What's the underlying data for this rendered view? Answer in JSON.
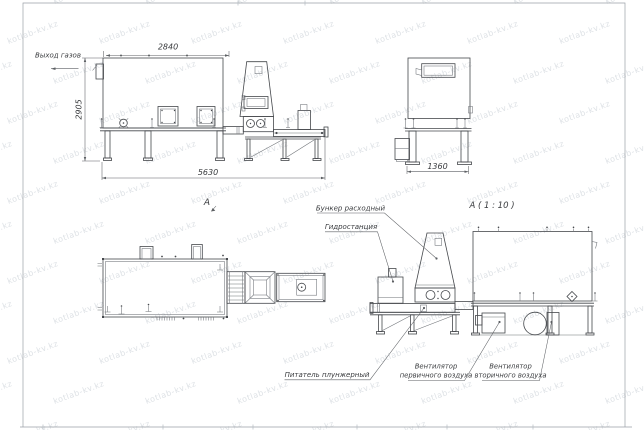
{
  "colors": {
    "line": "#45484c",
    "thin": "#6e7277",
    "text": "#393b3e",
    "dim": "#5c5f63",
    "watermark": "rgba(144,154,168,0.30)",
    "border": "#9aa0a6",
    "bg": "#ffffff"
  },
  "watermark": {
    "text": "kotlab-kv.kz"
  },
  "view_labels": {
    "section": "А",
    "detail": "А ( 1 : 10 )"
  },
  "dimensions": {
    "width_top": "2840",
    "height_left": "2905",
    "length_total": "5630",
    "width_end": "1360"
  },
  "callouts": {
    "gas_outlet": "Выход газов",
    "feed_hopper": "Бункер расходный",
    "hydraulic_station": "Гидростанция",
    "plunger_feeder": "Питатель плунжерный",
    "primary_fan_line1": "Вентилятор",
    "primary_fan_line2": "первичного воздуха",
    "secondary_fan_line1": "Вентилятор",
    "secondary_fan_line2": "вторичного воздуха"
  }
}
